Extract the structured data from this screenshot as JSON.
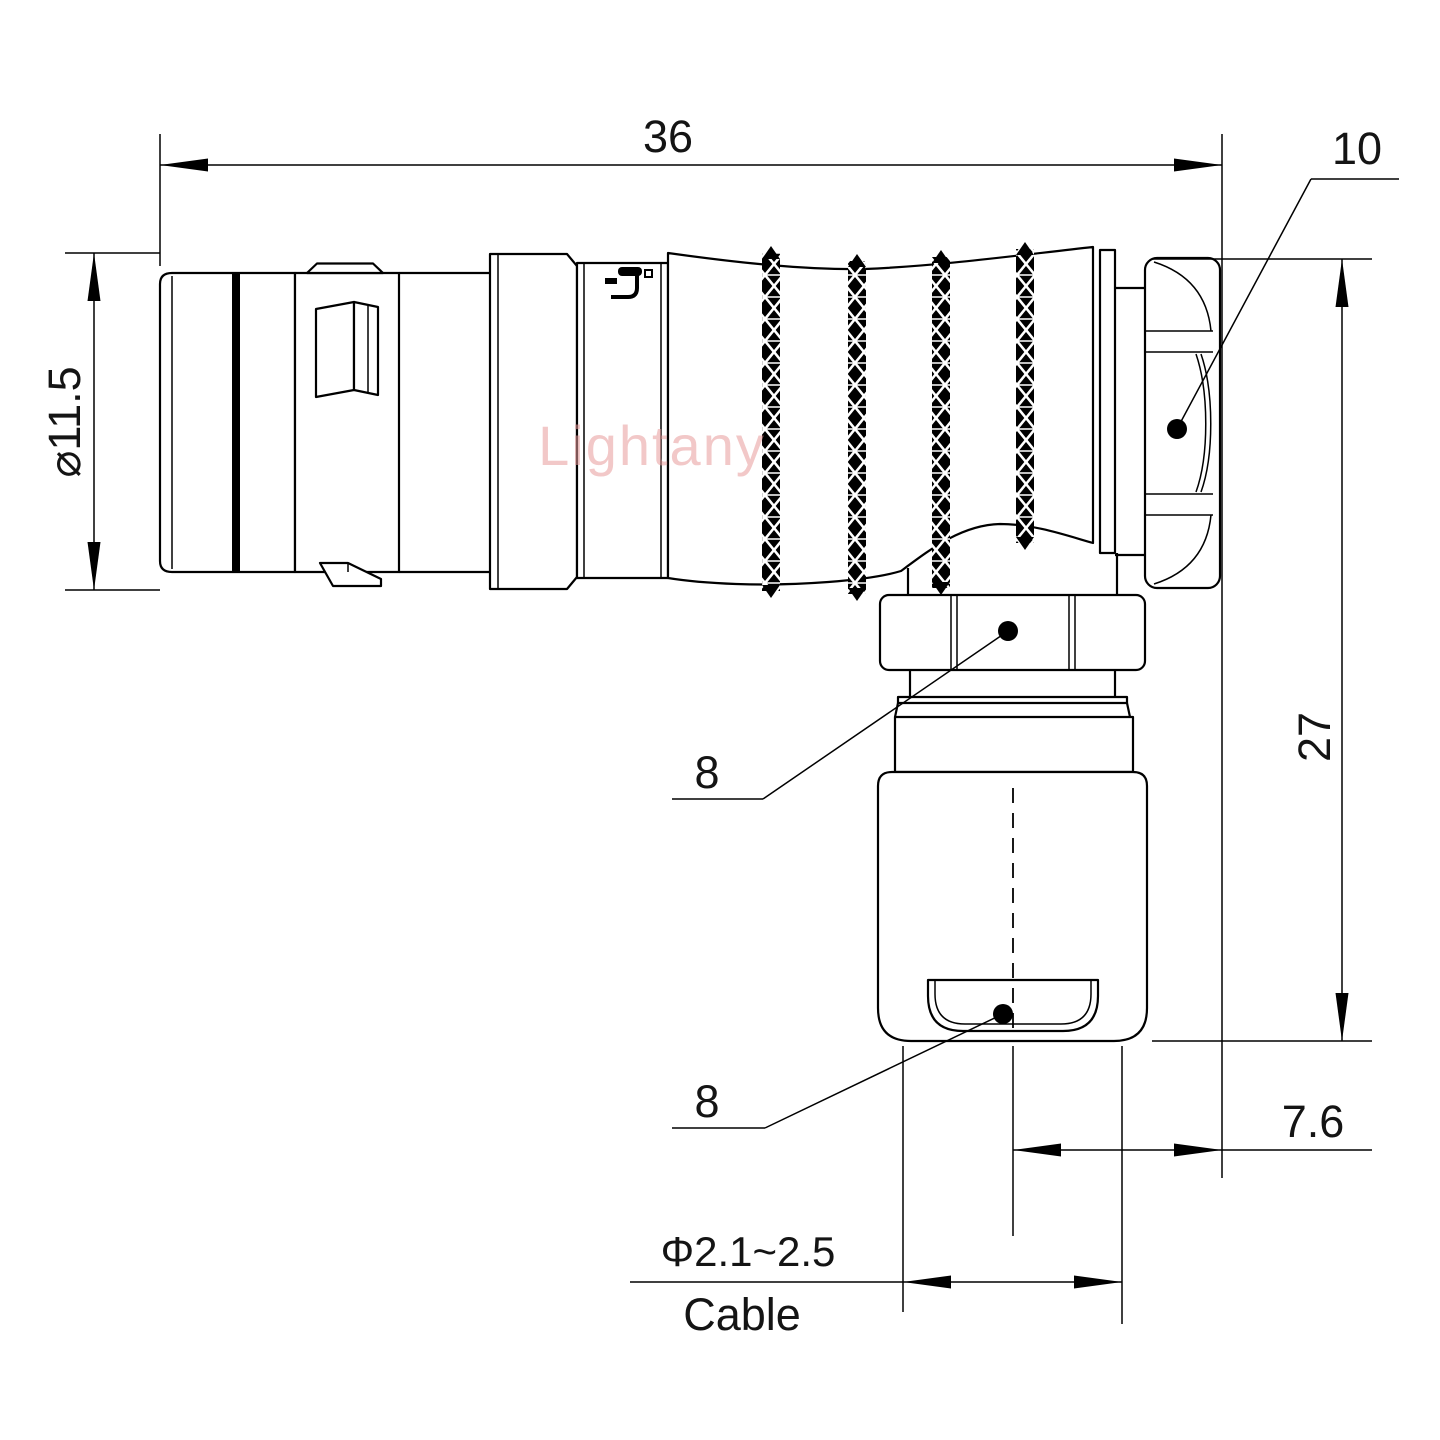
{
  "watermark": {
    "text": "Lightany",
    "color": "#e89c9c"
  },
  "dims": {
    "d36": "36",
    "d10": "10",
    "d115": "⌀11.5",
    "d27": "27",
    "d8a": "8",
    "d8b": "8",
    "d76": "7.6",
    "dcable": "Φ2.1~2.5",
    "cable_label": "Cable"
  },
  "colors": {
    "line": "#000000",
    "background": "#ffffff"
  }
}
